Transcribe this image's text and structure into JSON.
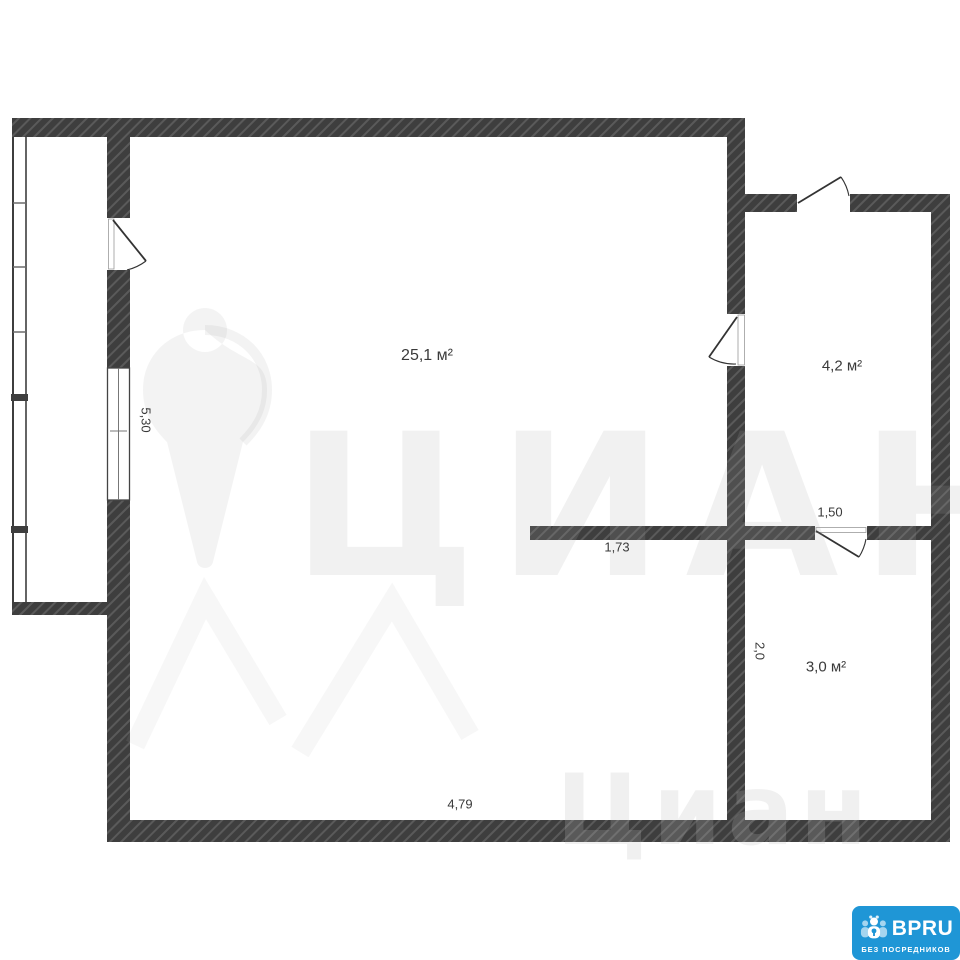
{
  "floorplan": {
    "rooms": [
      {
        "id": "main-room",
        "area_label": "25,1 м²"
      },
      {
        "id": "room-top-right",
        "area_label": "4,2 м²"
      },
      {
        "id": "room-bottom-right",
        "area_label": "3,0 м²"
      }
    ],
    "dimensions": [
      {
        "id": "dim-left-height",
        "label": "5,30",
        "orientation": "vertical"
      },
      {
        "id": "dim-partition-left",
        "label": "1,73",
        "orientation": "horizontal"
      },
      {
        "id": "dim-partition-door",
        "label": "1,50",
        "orientation": "horizontal"
      },
      {
        "id": "dim-right-height",
        "label": "2,0",
        "orientation": "vertical"
      },
      {
        "id": "dim-bottom-width",
        "label": "4,79",
        "orientation": "horizontal"
      }
    ],
    "watermark": {
      "brand_text_large": "ЦИАН",
      "brand_text_small": "Циан"
    },
    "logo": {
      "title": "BPRU",
      "subtitle": "БЕЗ ПОСРЕДНИКОВ"
    },
    "colors": {
      "wall": "#3e3e3e",
      "wall_hatch": "#5a5a5a",
      "logo_blue": "#1f96d6",
      "watermark_gray": "#f0f0f0",
      "label_text": "#3a3a3a"
    }
  }
}
